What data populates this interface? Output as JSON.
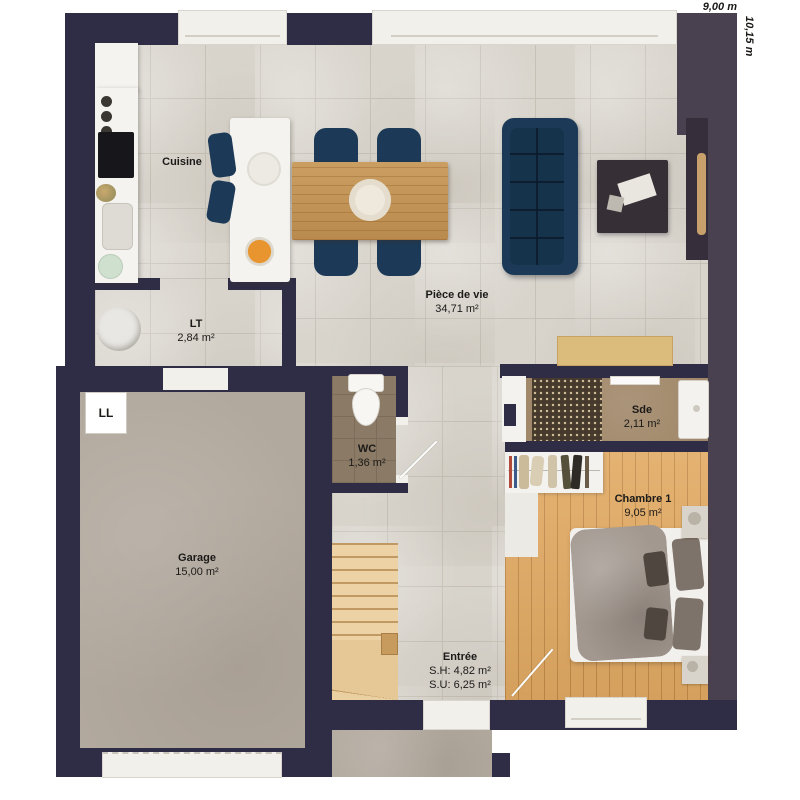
{
  "plan_title": "floor-plan-ground-level",
  "dimensions": {
    "width": "9,00 m",
    "depth": "10,15 m"
  },
  "rooms": {
    "cuisine": {
      "name": "Cuisine"
    },
    "piece_de_vie": {
      "name": "Pièce de vie",
      "area": "34,71 m²"
    },
    "lt": {
      "name": "LT",
      "area": "2,84 m²"
    },
    "wc": {
      "name": "WC",
      "area": "1,36 m²"
    },
    "garage": {
      "name": "Garage",
      "area": "15,00 m²"
    },
    "sde": {
      "name": "Sde",
      "area": "2,11 m²"
    },
    "chambre1": {
      "name": "Chambre 1",
      "area": "9,05 m²"
    },
    "entree": {
      "name": "Entrée",
      "area_sh": "S.H: 4,82 m²",
      "area_su": "S.U: 6,25 m²"
    }
  },
  "appliances": {
    "lave_linge": "LL"
  },
  "colors": {
    "wall": "#2f2d45",
    "wall_warm": "#4a4150",
    "tile_floor": "#d8d4cc",
    "wood_floor": "#e2aa63",
    "garage_floor": "#b2a99e",
    "wc_floor": "#8b7a66",
    "sde_floor": "#a1886a",
    "sofa_navy": "#1c3a57",
    "table_wood": "#c79a5e"
  }
}
